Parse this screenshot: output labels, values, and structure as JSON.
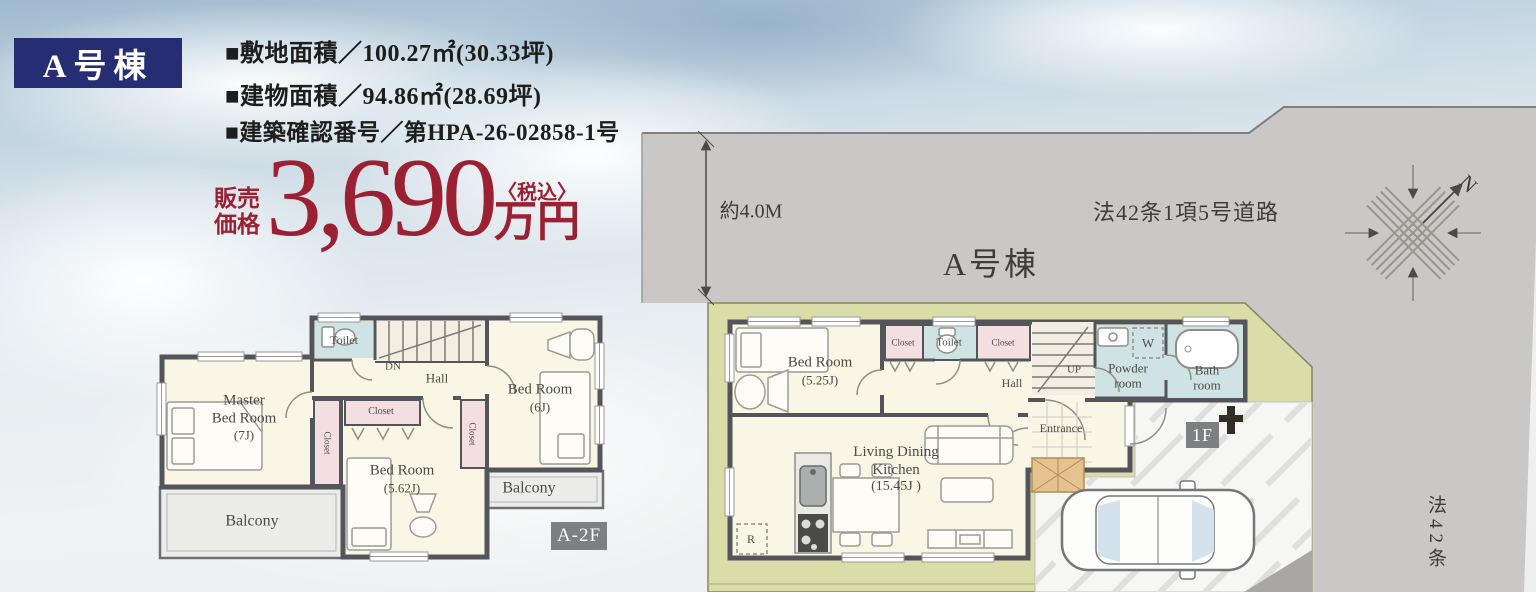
{
  "header": {
    "badge": "A号棟",
    "specs": [
      "■敷地面積／100.27㎡(30.33坪)",
      "■建物面積／94.86㎡(28.69坪)",
      "■建築確認番号／第HPA-26-02858-1号"
    ],
    "price": {
      "label1": "販売",
      "label2": "価格",
      "amount": "3,690",
      "tax": "〈税込〉",
      "unit": "万円"
    }
  },
  "site": {
    "road_width": "約4.0M",
    "road_name": "法42条1項5号道路",
    "building_label": "A号棟",
    "side_road": "法42条",
    "north": "N"
  },
  "plan2f": {
    "tag": "A-2F",
    "toilet": "Toilet",
    "down": "DN",
    "hall": "Hall",
    "master": [
      "Master",
      "Bed Room",
      "(7J)"
    ],
    "closet_master": "Closet",
    "closet_top": "Closet",
    "closet_6j": "Closet",
    "bed562": [
      "Bed Room",
      "(5.62J)"
    ],
    "bed6": [
      "Bed Room",
      "(6J)"
    ],
    "balcony_left": "Balcony",
    "balcony_right": "Balcony"
  },
  "plan1f": {
    "tag": "1F",
    "bed525": [
      "Bed Room",
      "(5.25J)"
    ],
    "closet_a": "Closet",
    "toilet": "Toilet",
    "closet_b": "Closet",
    "hall": "Hall",
    "up": "UP",
    "washer": "W",
    "powder": [
      "Powder",
      "room"
    ],
    "bath": [
      "Bath",
      "room"
    ],
    "entrance": "Entrance",
    "ldk": [
      "Living Dining",
      "Kitchen",
      "(15.45J )"
    ],
    "fridge": "R"
  },
  "colors": {
    "accent_navy": "#262d73",
    "price_red": "#9b2132",
    "site_green": "#dbdda9",
    "road_gray": "#c9c8c6",
    "water_blue": "#cfe3e5",
    "closet_pink": "#f3dee1",
    "floor_cream": "#faf6e6",
    "wall_gray": "#54555b"
  }
}
